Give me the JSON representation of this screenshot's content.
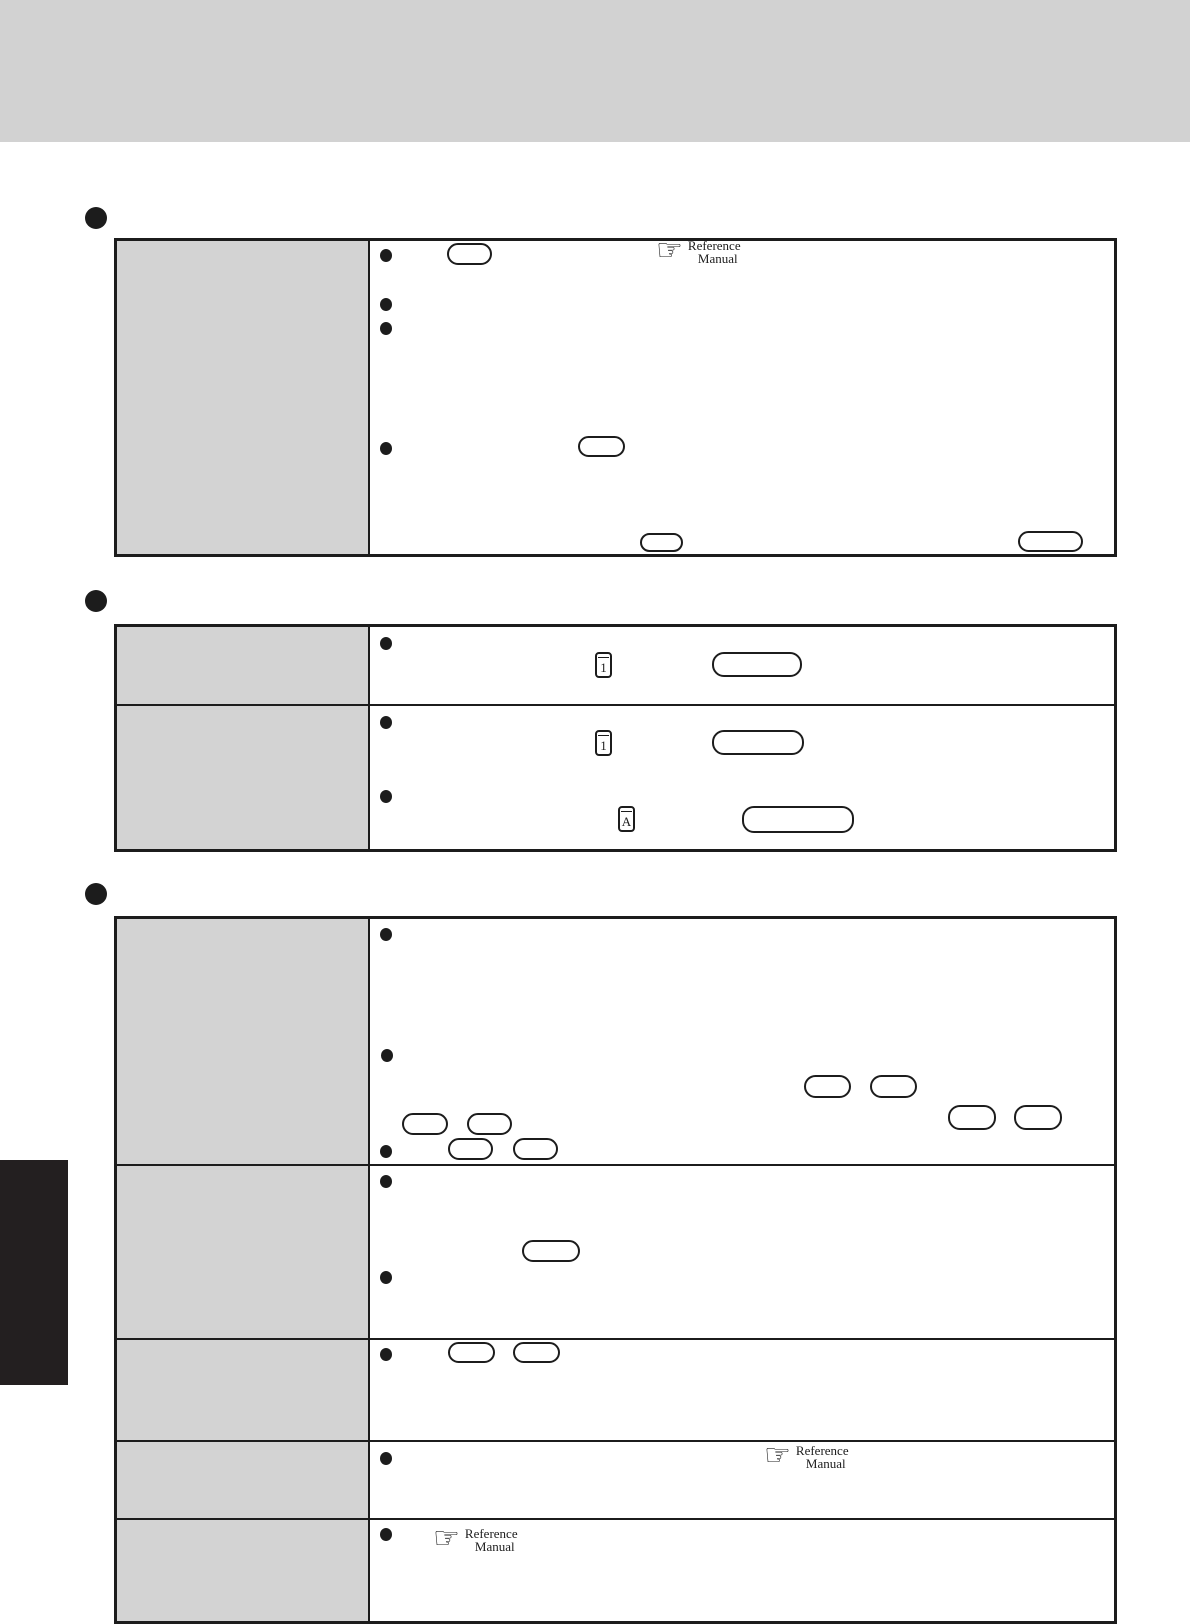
{
  "colors": {
    "header_band": "#d2d2d2",
    "table_header_cell": "#d3d3d3",
    "line": "#1c1c1c",
    "sidebar_tab": "#231f20",
    "page_background": "#ffffff"
  },
  "glyphs": {
    "hand_pointer": "☞"
  },
  "reference_manual": {
    "line1": "Reference",
    "line2": "Manual"
  },
  "key_labels": {
    "table2_row1": "1",
    "table2_row2": "1",
    "table2_row2b": "A"
  }
}
